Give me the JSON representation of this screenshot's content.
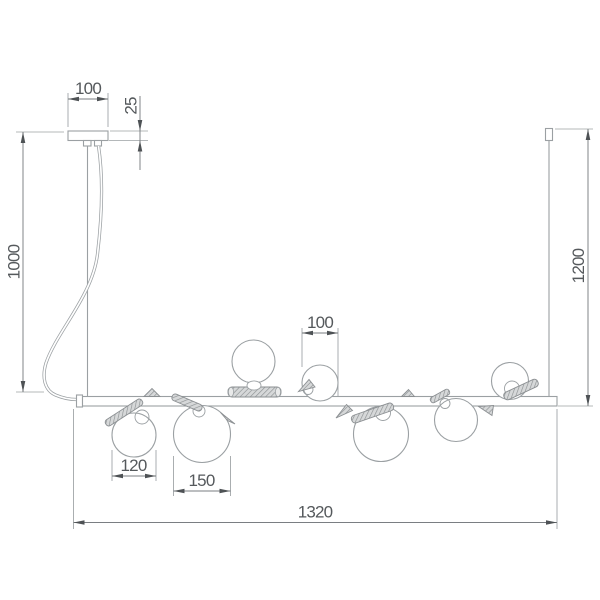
{
  "colors": {
    "background": "#ffffff",
    "geometry": "#9ba0a3",
    "dimension": "#7a7e82",
    "labeltext": "#55595c",
    "arrow": "#4e5255",
    "rod_fill": "#d6d8d9",
    "rod_hatch": "#8e9294"
  },
  "dimensions": {
    "canopy_width": "100",
    "canopy_offset": "25",
    "left_suspension_height": "1000",
    "right_suspension_height": "1200",
    "globe_top_diameter": "100",
    "globe_small_diameter": "120",
    "globe_large_diameter": "150",
    "fixture_total_length": "1320"
  }
}
